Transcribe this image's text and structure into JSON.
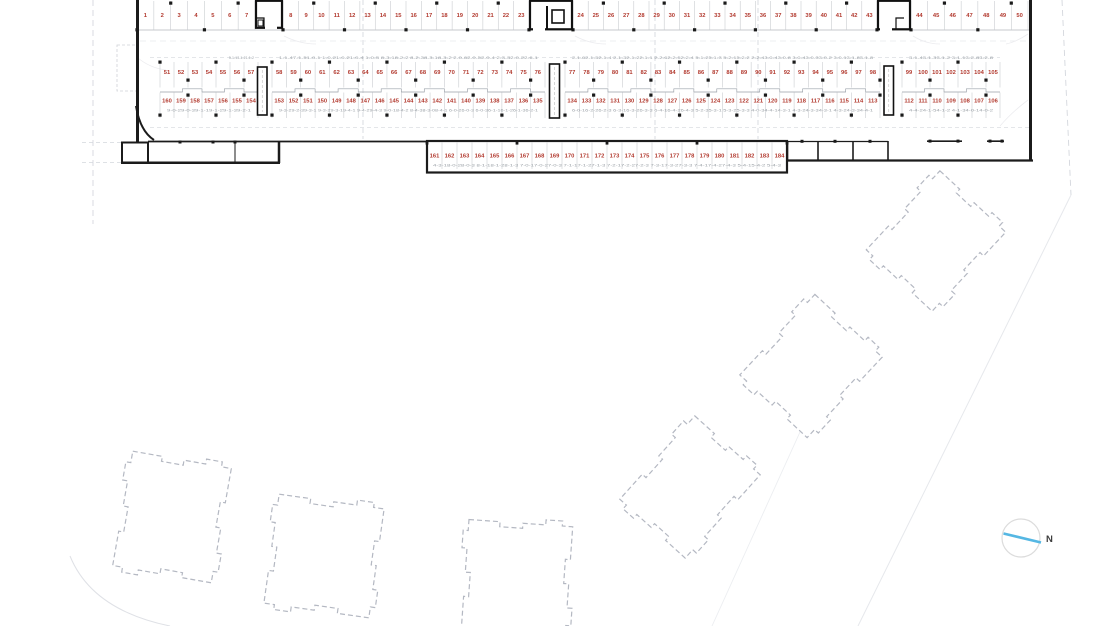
{
  "drawing": {
    "kind": "parking-site-plan",
    "north_label": "N",
    "total_spaces": 184
  },
  "colors": {
    "space_number": "#b23a2f",
    "annotation": "#9aa0a6",
    "wall": "#1b1b1b",
    "stall_line": "#c5c8cc",
    "row_line": "#b5b8bc",
    "dash_grid": "#c9cdd4",
    "building_dash": "#b4b8c2",
    "site_line": "#d4d7dd",
    "faint": "#ececef",
    "north_blue": "#55b7e3",
    "north_text": "#3c3c3c",
    "column": "#1a1a1a"
  },
  "parking": {
    "row1": {
      "segments": [
        {
          "x0": 137,
          "x1": 255,
          "numbers": [
            "1",
            "2",
            "3",
            "4",
            "5",
            "6",
            "7"
          ]
        },
        {
          "x0": 283,
          "x1": 529,
          "numbers": [
            "8",
            "9",
            "10",
            "11",
            "12",
            "13",
            "14",
            "15",
            "16",
            "17",
            "18",
            "19",
            "20",
            "21",
            "22",
            "23"
          ]
        },
        {
          "x0": 573,
          "x1": 877,
          "numbers": [
            "24",
            "25",
            "26",
            "27",
            "28",
            "29",
            "30",
            "31",
            "32",
            "33",
            "34",
            "35",
            "36",
            "37",
            "38",
            "39",
            "40",
            "41",
            "42",
            "43"
          ]
        },
        {
          "x0": 911,
          "x1": 1028,
          "numbers": [
            "44",
            "45",
            "46",
            "47",
            "48",
            "49",
            "50"
          ]
        }
      ]
    },
    "row2": {
      "segments": [
        {
          "x0": 160,
          "x1": 258,
          "numbers": [
            "51",
            "52",
            "53",
            "54",
            "55",
            "56",
            "57"
          ],
          "ann": "5-1-13-1-21-1-2",
          "annAlign": "right"
        },
        {
          "x0": 272,
          "x1": 545,
          "numbers": [
            "58",
            "59",
            "60",
            "61",
            "62",
            "63",
            "64",
            "65",
            "66",
            "67",
            "68",
            "69",
            "70",
            "71",
            "72",
            "73",
            "74",
            "75",
            "76"
          ],
          "ann": "1-1-47-1-51-0-1 1-0-21-0-21-0-4 1-0-5 8-3-18-2-2 8-2-38-3-18-3-2 2-0-62-0-52-0-4 2-3-32-0-22-6-1"
        },
        {
          "x0": 565,
          "x1": 880,
          "numbers": [
            "77",
            "78",
            "79",
            "80",
            "81",
            "82",
            "83",
            "84",
            "85",
            "86",
            "87",
            "88",
            "89",
            "90",
            "91",
            "92",
            "93",
            "94",
            "95",
            "96",
            "97",
            "98"
          ],
          "ann": "2-1-62-1-52-1-4 2-1-32-1-22-1-1 2-2-62-2-52-2-4 5-1-25-1-3 5-2-15-2-2 2-2-43-0-43-0-8 3-0-43-0-33-0-2 3-0-13-1-83-1-8"
        },
        {
          "x0": 902,
          "x1": 1000,
          "numbers": [
            "99",
            "100",
            "101",
            "102",
            "103",
            "104",
            "105"
          ],
          "ann": "3-1-43-1-33-1-2 3-1-13-2-83-2-8"
        }
      ]
    },
    "row3": {
      "segments": [
        {
          "x0": 160,
          "x1": 258,
          "numbers": [
            "160",
            "159",
            "158",
            "157",
            "156",
            "155",
            "154"
          ],
          "ann": "9-0-29-0-39-1-19-1-29-1-39-2-1"
        },
        {
          "x0": 272,
          "x1": 545,
          "numbers": [
            "153",
            "152",
            "151",
            "150",
            "149",
            "148",
            "147",
            "146",
            "145",
            "144",
            "143",
            "142",
            "141",
            "140",
            "139",
            "138",
            "137",
            "136",
            "135"
          ],
          "ann": "9-3-29-2-39-3-1 9-3-29-3-19-4-1 9-4-29-4-3 9-0-18-4-2 8-4-38-3-08-4-1 6-0-26-0-3 6-0-36-1-16-1-26-1-36-2-1"
        },
        {
          "x0": 565,
          "x1": 880,
          "numbers": [
            "134",
            "133",
            "132",
            "131",
            "130",
            "129",
            "128",
            "127",
            "126",
            "125",
            "124",
            "123",
            "122",
            "121",
            "120",
            "119",
            "118",
            "117",
            "116",
            "115",
            "114",
            "113"
          ],
          "ann": "6-0-16-2-26-2-3 6-3-16-3-26-3-3 6-4-16-4-26-4-3 5-2-35-3-1 5-3-25-3-3 4-0-34-4-14-3-1 4-3-24-3-34-3-1 4-3-24-3-34-4-1"
        },
        {
          "x0": 902,
          "x1": 1000,
          "numbers": [
            "112",
            "111",
            "110",
            "109",
            "108",
            "107",
            "106"
          ],
          "ann": "4-4-24-1-54-1-2 4-1-34-0-14-0-2"
        }
      ]
    },
    "row4": {
      "x0": 427,
      "x1": 787,
      "numbers": [
        "161",
        "162",
        "163",
        "164",
        "165",
        "166",
        "167",
        "168",
        "169",
        "170",
        "171",
        "172",
        "173",
        "174",
        "175",
        "176",
        "177",
        "178",
        "179",
        "180",
        "181",
        "182",
        "183",
        "184"
      ],
      "ann": "4-3-18-0-28-0-3 8-1-18-1-28-1-3 7-0-17-0-27-0-3 7-1-17-1-27-1-3 7-2-17-2-27-2-3 7-3-17-3-27-3-3 7-4-17-4-27-4-3 5-4-15-4-2 5-4-3"
    }
  },
  "buildings": [
    {
      "cx": 936,
      "cy": 241,
      "hw": 45,
      "hh": 54,
      "rot": 43
    },
    {
      "cx": 811,
      "cy": 366,
      "hw": 46,
      "hh": 55,
      "rot": 43
    },
    {
      "cx": 690,
      "cy": 487,
      "hw": 44,
      "hh": 56,
      "rot": 42
    },
    {
      "cx": 172,
      "cy": 517,
      "hw": 50,
      "hh": 58,
      "rot": 10
    },
    {
      "cx": 324,
      "cy": 556,
      "hw": 53,
      "hh": 55,
      "rot": 8
    },
    {
      "cx": 517,
      "cy": 578,
      "hw": 52,
      "hh": 55,
      "rot": 4
    }
  ]
}
